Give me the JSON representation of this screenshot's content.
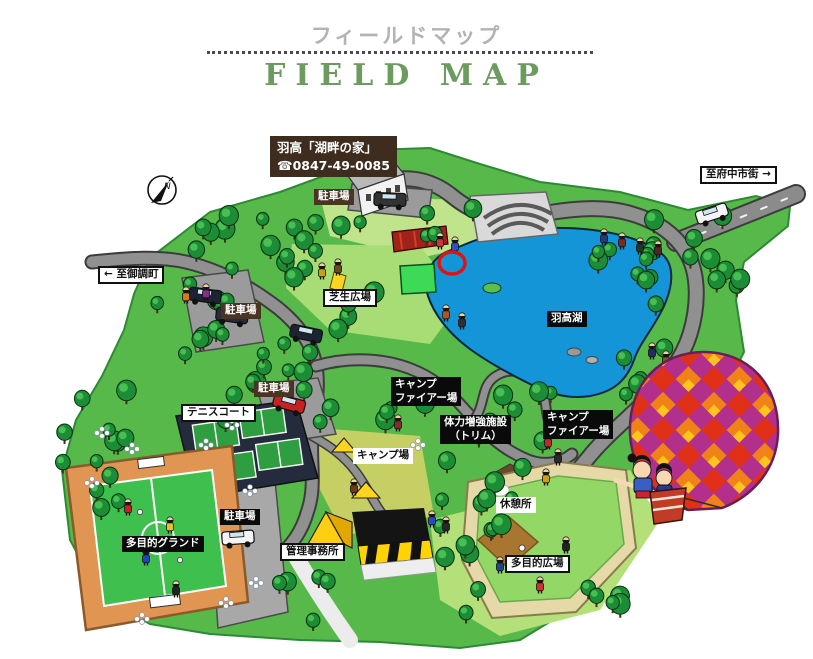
{
  "header": {
    "title_ja": "フィールドマップ",
    "title_en": "FIELD MAP"
  },
  "lodge_sign": {
    "name": "羽高「湖畔の家」",
    "phone": "☎0847-49-0085"
  },
  "compass": {
    "letter": "N"
  },
  "map_labels": [
    {
      "id": "parking-top",
      "text": "駐車場",
      "style": "brown",
      "x": 314,
      "y": 189
    },
    {
      "id": "direction-fuchu",
      "text": "至府中市街 →",
      "style": "white-border",
      "x": 700,
      "y": 166
    },
    {
      "id": "direction-mitsugi",
      "text": "← 至御調町",
      "style": "white-border",
      "x": 98,
      "y": 266
    },
    {
      "id": "parking-left",
      "text": "駐車場",
      "style": "brown",
      "x": 221,
      "y": 303
    },
    {
      "id": "lawn-plaza",
      "text": "芝生広場",
      "style": "white-border",
      "x": 323,
      "y": 289
    },
    {
      "id": "lake-name",
      "text": "羽高湖",
      "style": "black",
      "x": 547,
      "y": 311
    },
    {
      "id": "campfire-site-west",
      "lines": [
        "キャンプ",
        "ファイアー場"
      ],
      "style": "black",
      "x": 391,
      "y": 377
    },
    {
      "id": "trim-facility",
      "lines": [
        "体力増強施設",
        "（トリム）"
      ],
      "style": "black",
      "x": 440,
      "y": 415,
      "align": "center"
    },
    {
      "id": "campfire-site-east",
      "lines": [
        "キャンプ",
        "ファイアー場"
      ],
      "style": "black",
      "x": 543,
      "y": 410
    },
    {
      "id": "campsite",
      "text": "キャンプ場",
      "style": "white",
      "x": 353,
      "y": 448
    },
    {
      "id": "tennis-court",
      "text": "テニスコート",
      "style": "white-border",
      "x": 181,
      "y": 404
    },
    {
      "id": "parking-tennis",
      "text": "駐車場",
      "style": "brown",
      "x": 254,
      "y": 381
    },
    {
      "id": "multipurpose-ground",
      "text": "多目的グランド",
      "style": "black",
      "x": 122,
      "y": 536
    },
    {
      "id": "parking-south",
      "text": "駐車場",
      "style": "black",
      "x": 220,
      "y": 509
    },
    {
      "id": "admin-office",
      "text": "管理事務所",
      "style": "white-border",
      "x": 280,
      "y": 543
    },
    {
      "id": "rest-area",
      "text": "休憩所",
      "style": "white",
      "x": 496,
      "y": 497
    },
    {
      "id": "multipurpose-plaza",
      "text": "多目的広場",
      "style": "white-border",
      "x": 505,
      "y": 555
    }
  ],
  "colors": {
    "title_en_green": "#6b9b5e",
    "title_ja_gray": "#b3b3b6",
    "lake_blue": "#1495d8",
    "land_green": "#58b94b",
    "forest_green": "#1c8c36",
    "road_gray": "#909090",
    "label_brown": "#4a3423",
    "label_black": "#0a0a0a",
    "marker_red": "#e01212",
    "balloon_magenta": "#b2308c",
    "balloon_orange": "#f08218",
    "balloon_red": "#e03118",
    "balloon_yellow": "#ffc41e"
  }
}
